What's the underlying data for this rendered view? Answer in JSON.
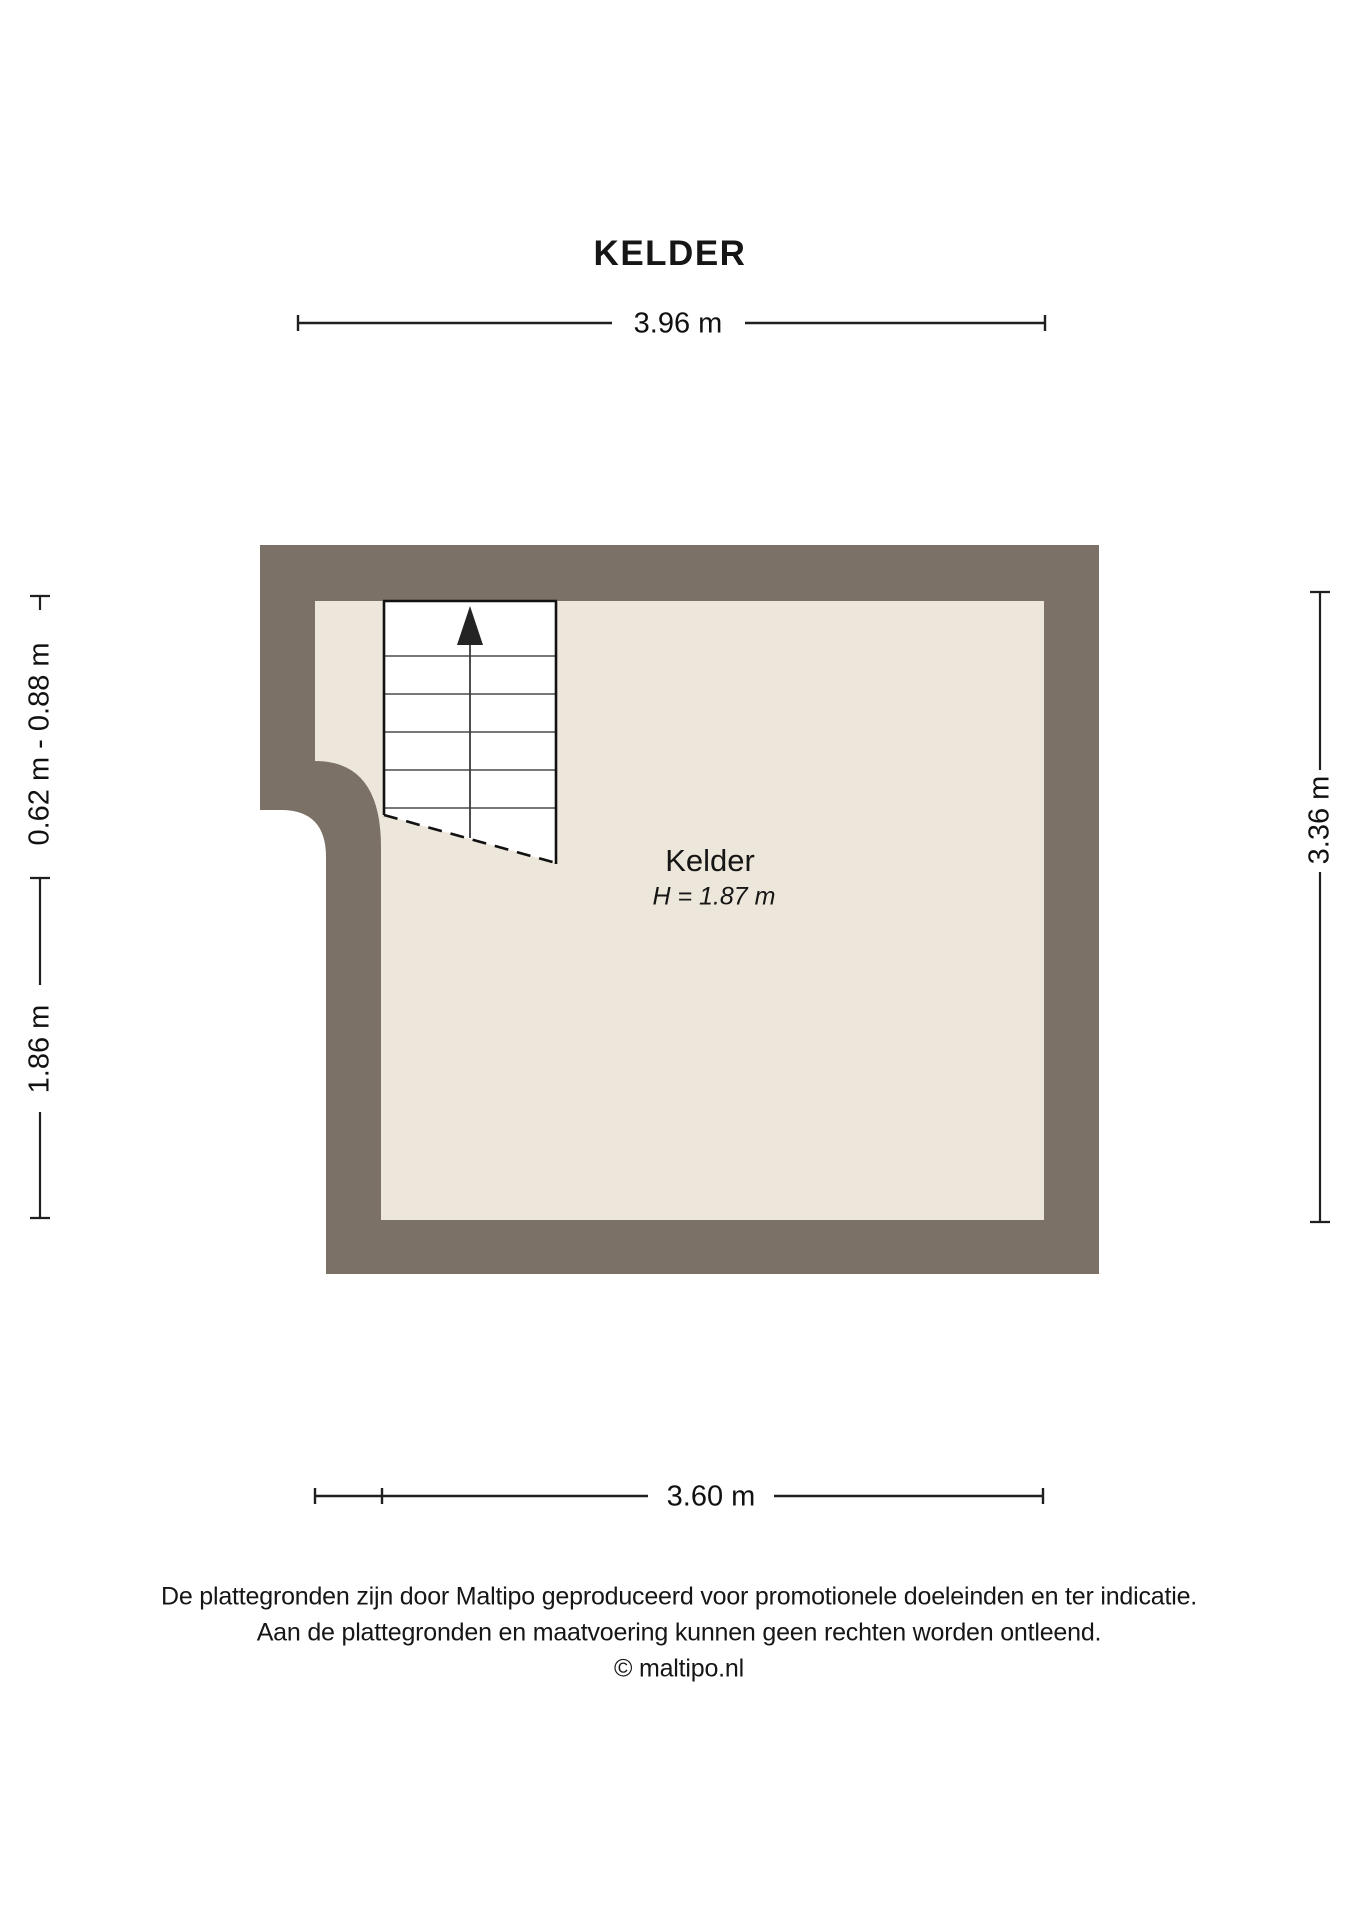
{
  "title": "KELDER",
  "room": {
    "name": "Kelder",
    "height_label": "H = 1.87 m"
  },
  "dimensions": {
    "top": "3.96 m",
    "left_upper": "0.62 m - 0.88 m",
    "left_lower": "1.86 m",
    "right": "3.36 m",
    "bottom": "3.60 m"
  },
  "footer": {
    "line1": "De plattegronden zijn door Maltipo geproduceerd voor promotionele doeleinden en ter indicatie.",
    "line2": "Aan de plattegronden en maatvoering kunnen geen rechten worden ontleend.",
    "line3": "© maltipo.nl"
  },
  "colors": {
    "wall": "#7B7167",
    "floor": "#EDE6DA",
    "stair_fill": "#FFFFFF",
    "line_dark": "#1f1f1f",
    "step_line": "#4a4a4a"
  }
}
